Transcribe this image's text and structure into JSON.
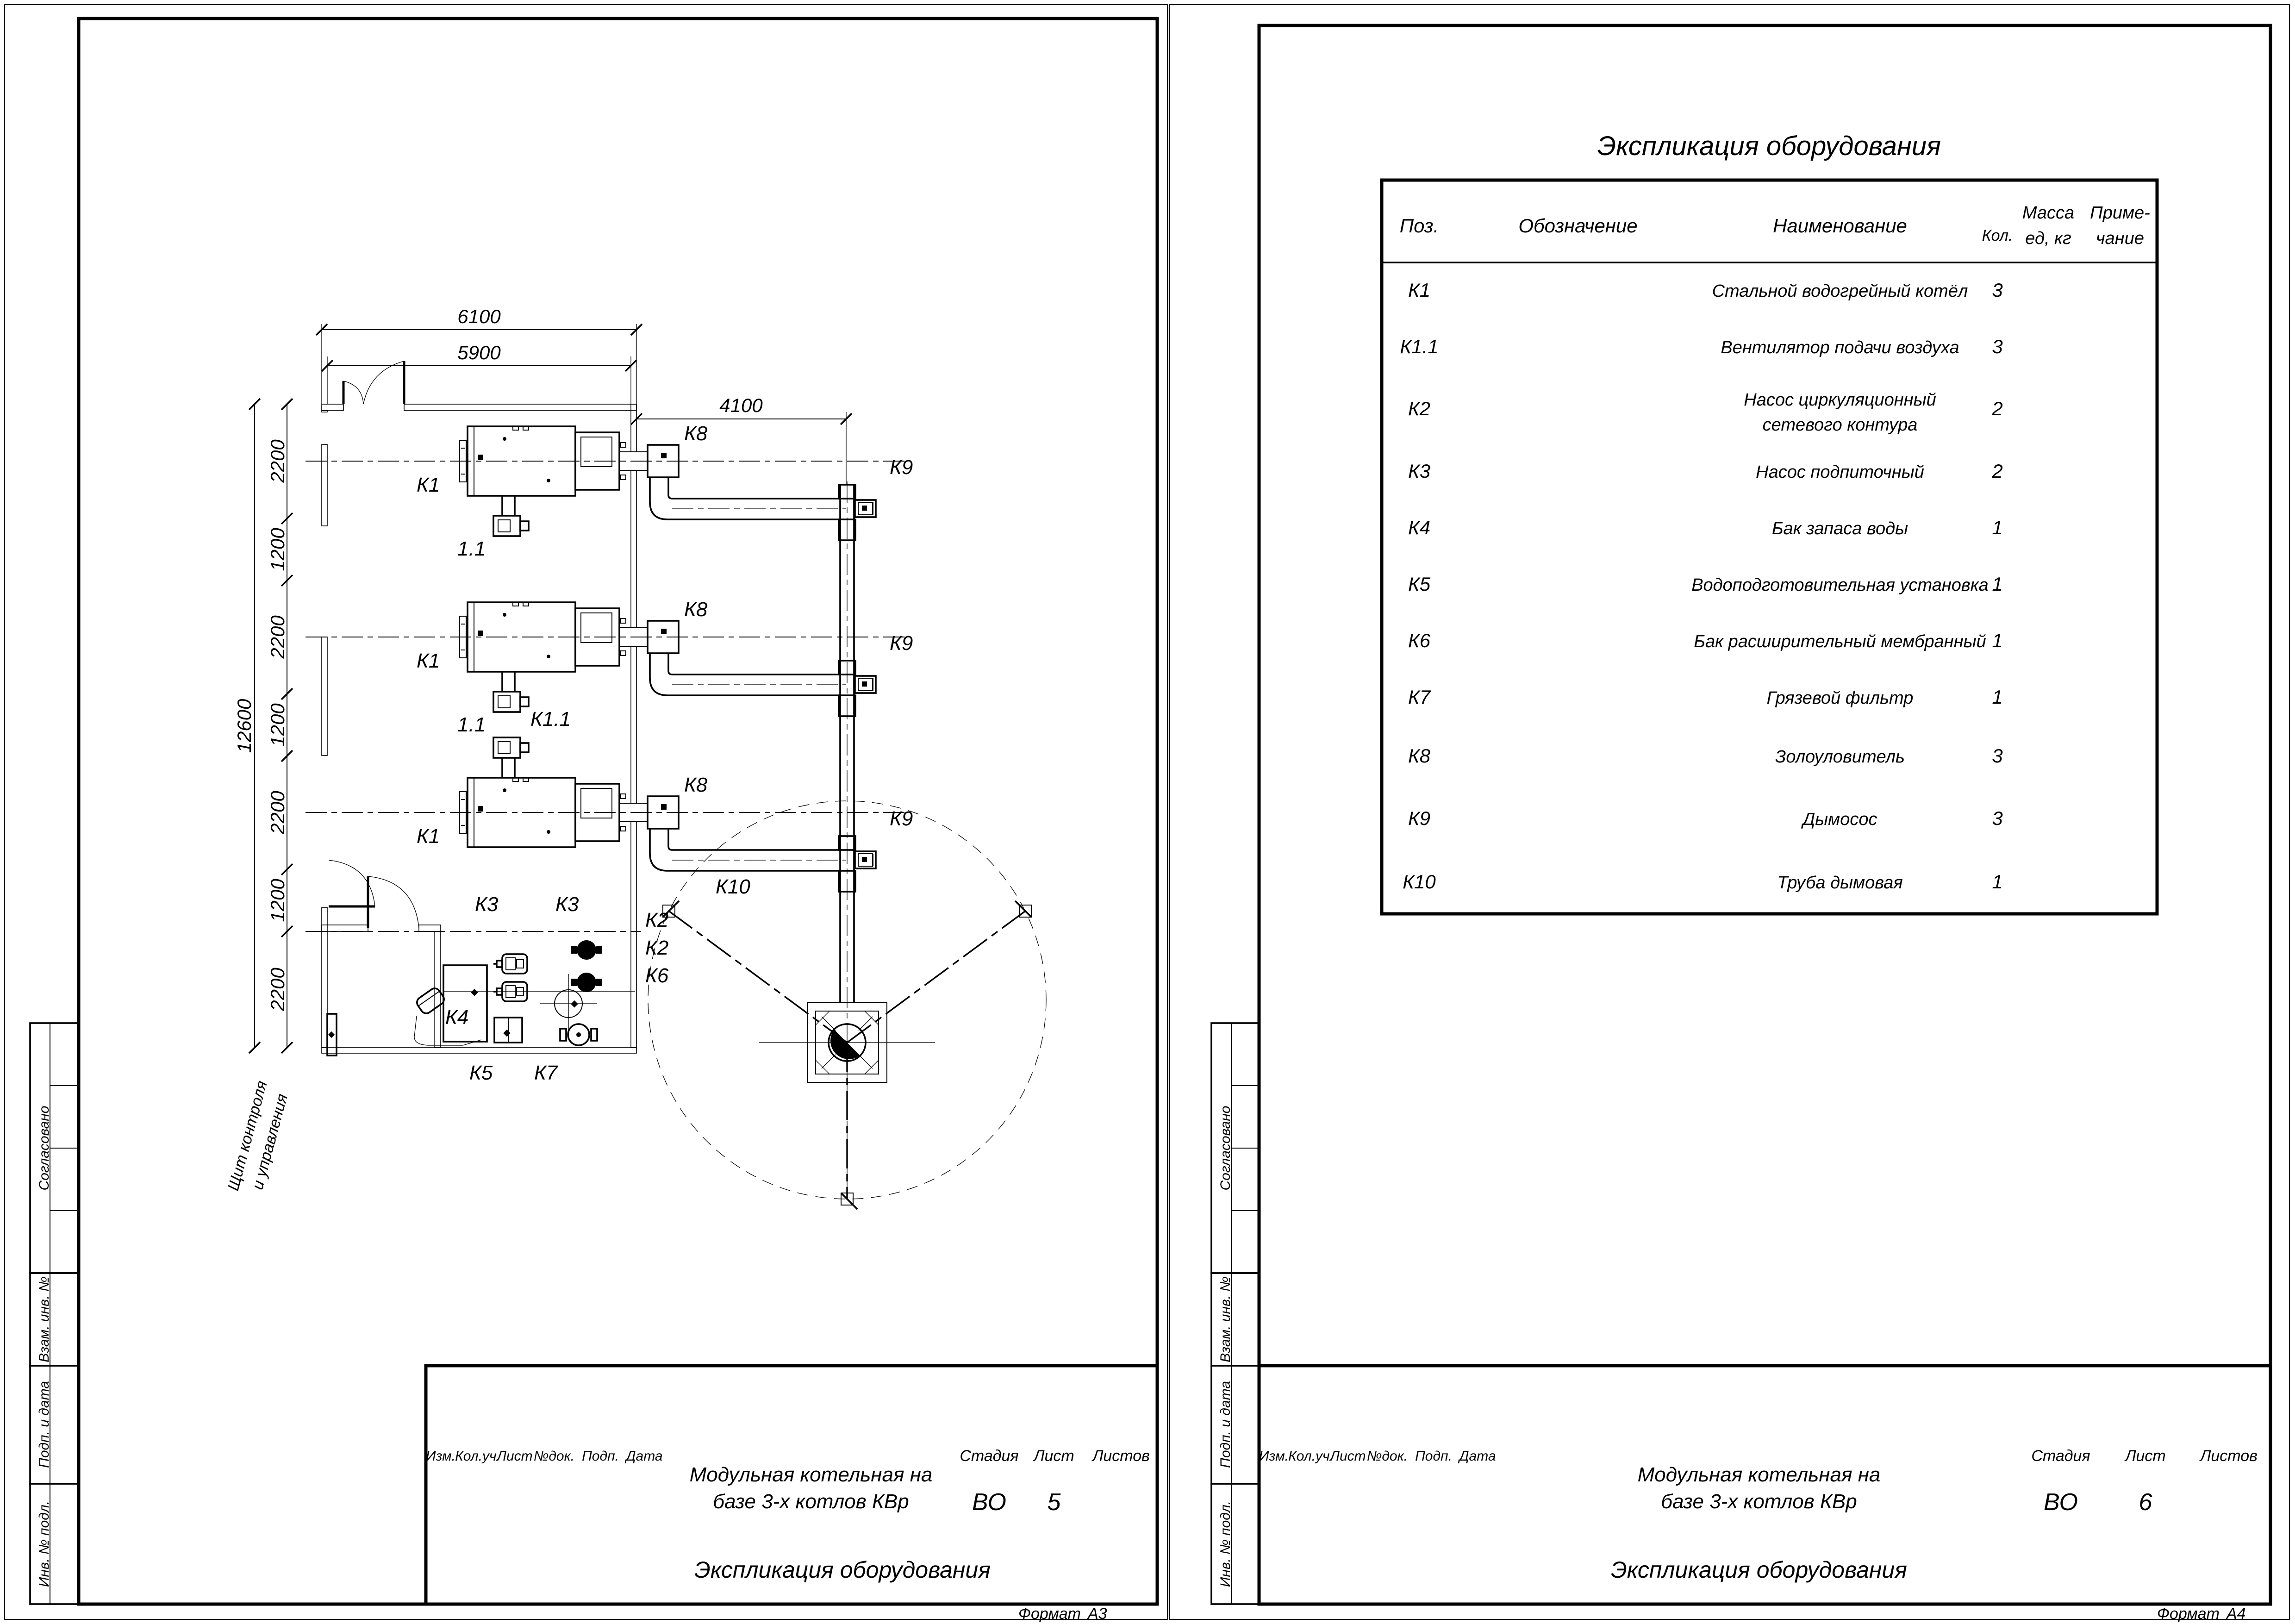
{
  "doc": {
    "table": {
      "title": "Экспликация оборудования",
      "h_pos": "Поз.",
      "h_desig": "Обозначение",
      "h_name": "Наименование",
      "h_qty": "Кол.",
      "h_mass1": "Масса",
      "h_mass2": "ед, кг",
      "h_note1": "Приме-",
      "h_note2": "чание",
      "rows": [
        {
          "pos": "К1",
          "name": "Стальной водогрейный котёл",
          "name2": "",
          "qty": "3"
        },
        {
          "pos": "К1.1",
          "name": "Вентилятор подачи воздуха",
          "name2": "",
          "qty": "3"
        },
        {
          "pos": "К2",
          "name": "Насос циркуляционный",
          "name2": "сетевого контура",
          "qty": "2"
        },
        {
          "pos": "К3",
          "name": "Насос подпиточный",
          "name2": "",
          "qty": "2"
        },
        {
          "pos": "К4",
          "name": "Бак запаса воды",
          "name2": "",
          "qty": "1"
        },
        {
          "pos": "К5",
          "name": "Водоподготовительная установка",
          "name2": "",
          "qty": "1"
        },
        {
          "pos": "К6",
          "name": "Бак расширительный мембранный",
          "name2": "",
          "qty": "1"
        },
        {
          "pos": "К7",
          "name": "Грязевой фильтр",
          "name2": "",
          "qty": "1"
        },
        {
          "pos": "К8",
          "name": "Золоуловитель",
          "name2": "",
          "qty": "3"
        },
        {
          "pos": "К9",
          "name": "Дымосос",
          "name2": "",
          "qty": "3"
        },
        {
          "pos": "К10",
          "name": "Труба дымовая",
          "name2": "",
          "qty": "1"
        }
      ]
    },
    "stamp": {
      "project1": "Модульная котельная на",
      "project2": "базе 3-х котлов КВр",
      "doc_title": "Экспликация оборудования",
      "stage_lbl": "Стадия",
      "sheet_lbl": "Лист",
      "sheets_lbl": "Листов",
      "stage": "ВО",
      "sheet_left": "5",
      "sheet_right": "6",
      "rev": [
        "Изм.",
        "Кол.уч.",
        "Лист",
        "№док.",
        "Подп.",
        "Дата"
      ],
      "format_lbl": "Формат",
      "format_left": "А3",
      "format_right": "А4",
      "side": [
        "Согласовано",
        "Взам. инв. №",
        "Подп. и дата",
        "Инв. № подл."
      ]
    },
    "plan": {
      "dim": {
        "w1": "6100",
        "w2": "5900",
        "w3": "4100",
        "h": "12600",
        "c0": "2200",
        "c1": "1200",
        "c2": "2200",
        "c3": "1200",
        "c4": "2200",
        "c5": "1200",
        "c6": "2200"
      },
      "lbl": {
        "k1": "К1",
        "k11": "К1.1",
        "u11": "1.1",
        "k2": "К2",
        "k3": "К3",
        "k4": "К4",
        "k5": "К5",
        "k6": "К6",
        "k7": "К7",
        "k8": "К8",
        "k9": "К9",
        "k10": "К10",
        "panel1": "Щит контроля",
        "panel2": "и управления"
      }
    }
  }
}
